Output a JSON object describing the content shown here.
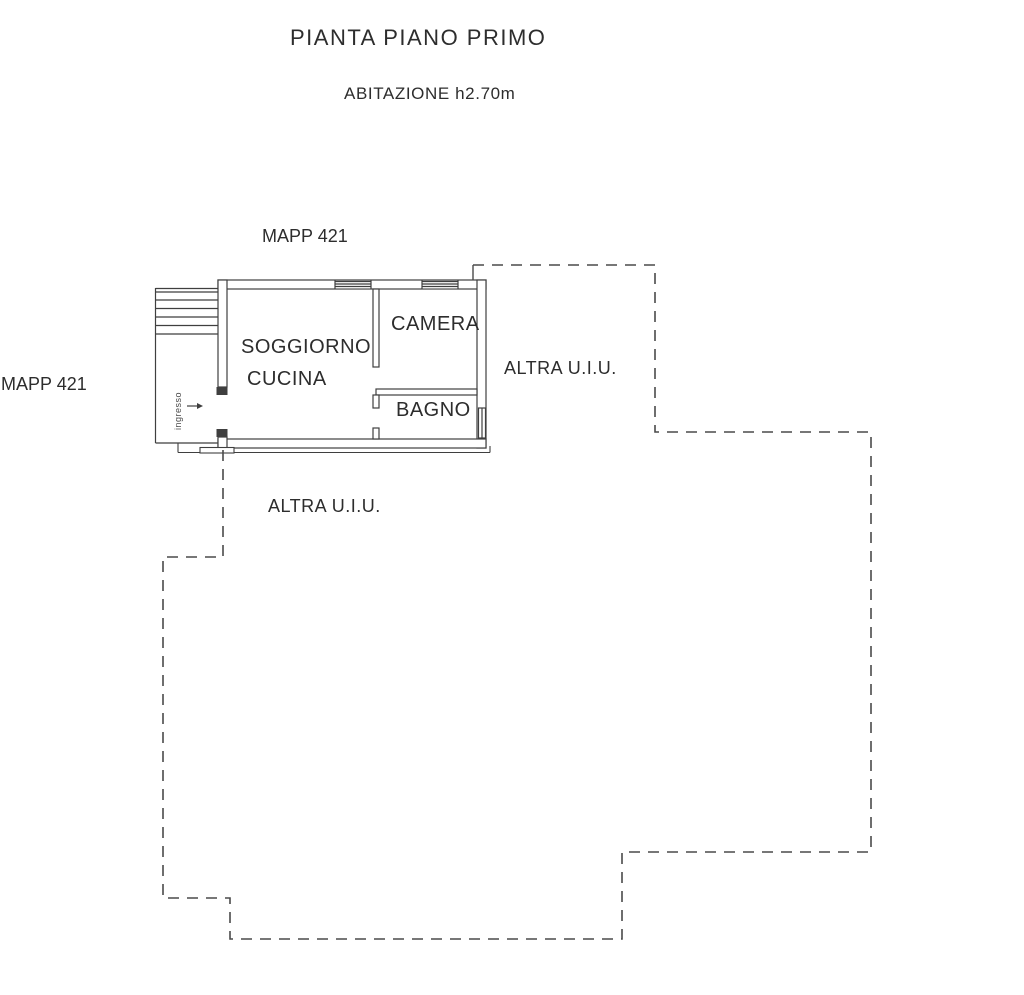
{
  "page": {
    "title": "PIANTA PIANO PRIMO",
    "subtitle": "ABITAZIONE h2.70m"
  },
  "plan": {
    "mapp_label_top": "MAPP 421",
    "mapp_label_left": "MAPP 421",
    "altra_uiu_right": "ALTRA U.I.U.",
    "altra_uiu_bottom": "ALTRA U.I.U.",
    "entrance_label": "ingresso",
    "entrance_arrow_glyph": "→",
    "rooms": {
      "soggiorno_line1": "SOGGIORNO",
      "soggiorno_line2": "CUCINA",
      "camera": "CAMERA",
      "bagno": "BAGNO"
    }
  },
  "colors": {
    "ink": "#3f3f3f",
    "boundary_dash": "#4a4a4a",
    "text": "#2d2d2d",
    "paper": "#ffffff"
  }
}
